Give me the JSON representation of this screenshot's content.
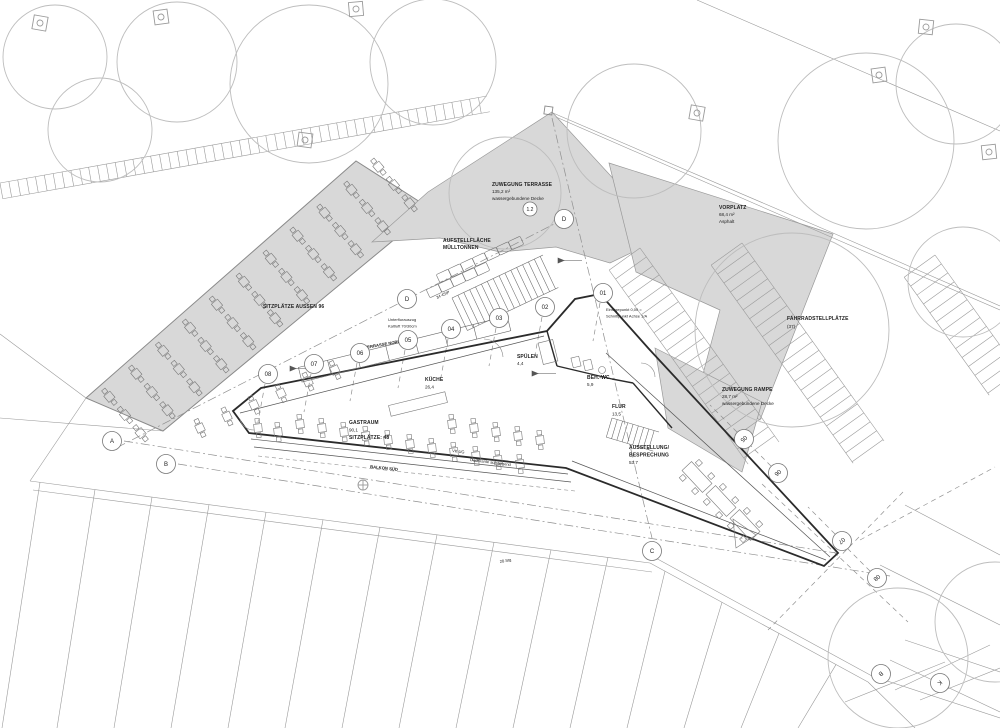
{
  "colors": {
    "paper": "#ffffff",
    "area_fill": "#d8d8d8",
    "line": "#9a9a9a",
    "tree": "#bdbdbd",
    "wall": "#2b2b2b",
    "text": "#222222"
  },
  "areas": [
    {
      "name": "ZUWEGUNG TERRASSE",
      "size": "135,2 m²",
      "surface": "wassergebundene Decke"
    },
    {
      "name": "VORPLATZ",
      "size": "68,4 m²",
      "surface": "Asphalt"
    },
    {
      "line1": "AUFSTELLFLÄCHE",
      "line2": "MÜLLTONNEN"
    },
    {
      "name": "FAHRRADSTELLPLÄTZE",
      "count": "(37)"
    },
    {
      "name": "ZUWEGUNG RAMPE",
      "size": "28,7 m²",
      "surface": "wassergebundene Decke"
    },
    {
      "name": "SITZPLÄTZE AUSSEN  96"
    },
    {
      "name": "TERRASSE NORD"
    },
    {
      "name": "BALKON SÜD"
    }
  ],
  "rooms": [
    {
      "name": "KÜCHE",
      "size": "26,4"
    },
    {
      "name": "SPÜLEN",
      "size": "4,4"
    },
    {
      "name": "GASTRAUM",
      "size": "90,1",
      "seats": "SITZPLÄTZE: 48"
    },
    {
      "name": "BEH.-WC",
      "size": "5,9"
    },
    {
      "name": "FLUR",
      "size": "13,5"
    },
    {
      "line1": "AUSSTELLUNG/",
      "line2": "BESPRECHUNG",
      "size": "53,7"
    }
  ],
  "annotations": {
    "einfuegepunkt_line1": "Einfügepunkt 0,00 =",
    "einfuegepunkt_line2": "Schnittpunkt Achse 1/A",
    "unterflur_line1": "Unterflurauszug",
    "unterflur_line2": "Kaltluft 70/30cm",
    "stair_steps": "34 4StP",
    "ramp_steps": "28 Stg",
    "vk_ug": "VK UG",
    "dachkante": "Dachkante aufsteigend"
  },
  "markers": {
    "letters": [
      {
        "label": "A",
        "x": 112,
        "y": 441,
        "rot": 0
      },
      {
        "label": "B",
        "x": 166,
        "y": 464,
        "rot": 0
      },
      {
        "label": "C",
        "x": 652,
        "y": 551,
        "rot": 0
      },
      {
        "label": "D",
        "x": 564,
        "y": 219,
        "rot": 0
      },
      {
        "label": "D",
        "x": 407,
        "y": 299,
        "rot": 0
      },
      {
        "label": "B",
        "x": 881,
        "y": 674,
        "rot": 140
      },
      {
        "label": "K",
        "x": 940,
        "y": 683,
        "rot": 140
      }
    ],
    "numbers": [
      {
        "label": "01",
        "x": 603,
        "y": 293,
        "rot": 0,
        "stub": "down"
      },
      {
        "label": "02",
        "x": 545,
        "y": 307,
        "rot": 0,
        "stub": "down"
      },
      {
        "label": "03",
        "x": 499,
        "y": 318,
        "rot": 0,
        "stub": "down"
      },
      {
        "label": "04",
        "x": 451,
        "y": 329,
        "rot": 0,
        "stub": "down"
      },
      {
        "label": "05",
        "x": 408,
        "y": 340,
        "rot": 0,
        "stub": "down"
      },
      {
        "label": "06",
        "x": 360,
        "y": 353,
        "rot": 0,
        "stub": "down"
      },
      {
        "label": "07",
        "x": 314,
        "y": 364,
        "rot": 0,
        "stub": "down"
      },
      {
        "label": "08",
        "x": 268,
        "y": 374,
        "rot": 0,
        "stub": "down"
      },
      {
        "label": "05",
        "x": 744,
        "y": 439,
        "rot": 140,
        "stub": "diag"
      },
      {
        "label": "06",
        "x": 778,
        "y": 473,
        "rot": 140,
        "stub": "diag"
      },
      {
        "label": "07",
        "x": 842,
        "y": 541,
        "rot": 140,
        "stub": "diag"
      },
      {
        "label": "08",
        "x": 877,
        "y": 578,
        "rot": 140,
        "stub": "diag"
      }
    ],
    "point": {
      "label": "1.2",
      "x": 530,
      "y": 209
    }
  }
}
